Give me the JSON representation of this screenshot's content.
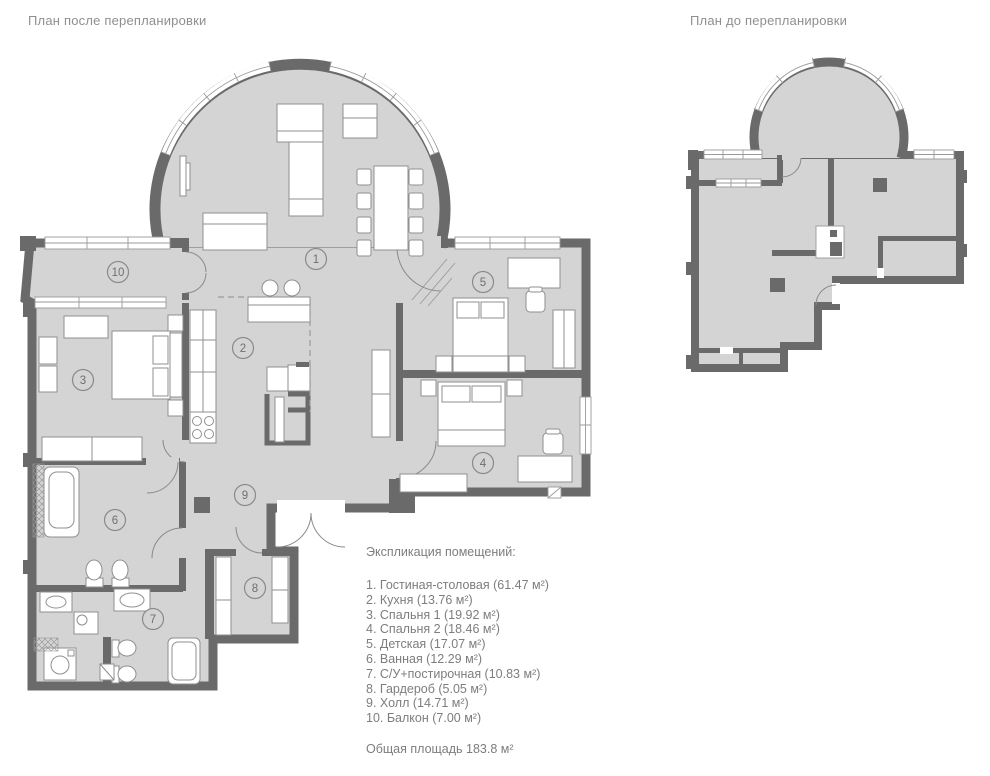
{
  "plans": {
    "after": {
      "title": "План после перепланировки"
    },
    "before": {
      "title": "План до перепланировки"
    }
  },
  "legend": {
    "title": "Экспликация помещений:",
    "items": [
      {
        "text": "1. Гостиная-столовая (61.47 м²)"
      },
      {
        "text": "2. Кухня (13.76 м²)"
      },
      {
        "text": "3. Спальня 1 (19.92 м²)"
      },
      {
        "text": "4. Спальня 2 (18.46 м²)"
      },
      {
        "text": "5. Детская (17.07 м²)"
      },
      {
        "text": "6. Ванная (12.29 м²)"
      },
      {
        "text": "7. С/У+постирочная (10.83 м²)"
      },
      {
        "text": "8. Гардероб (5.05 м²)"
      },
      {
        "text": "9. Холл (14.71 м²)"
      },
      {
        "text": "10. Балкон (7.00 м²)"
      }
    ],
    "total": "Общая площадь 183.8 м²"
  },
  "room_markers": {
    "after": [
      "1",
      "2",
      "3",
      "4",
      "5",
      "6",
      "7",
      "8",
      "9",
      "10"
    ]
  },
  "colors": {
    "bg": "#ffffff",
    "paper": "#ffffff",
    "wall": "#6a6a6a",
    "floor": "#d4d4d4",
    "furn-stroke": "#8f8f8f",
    "thin": "#9a9a9a",
    "text": "#7d7d7d",
    "title": "#8f8f8f"
  }
}
